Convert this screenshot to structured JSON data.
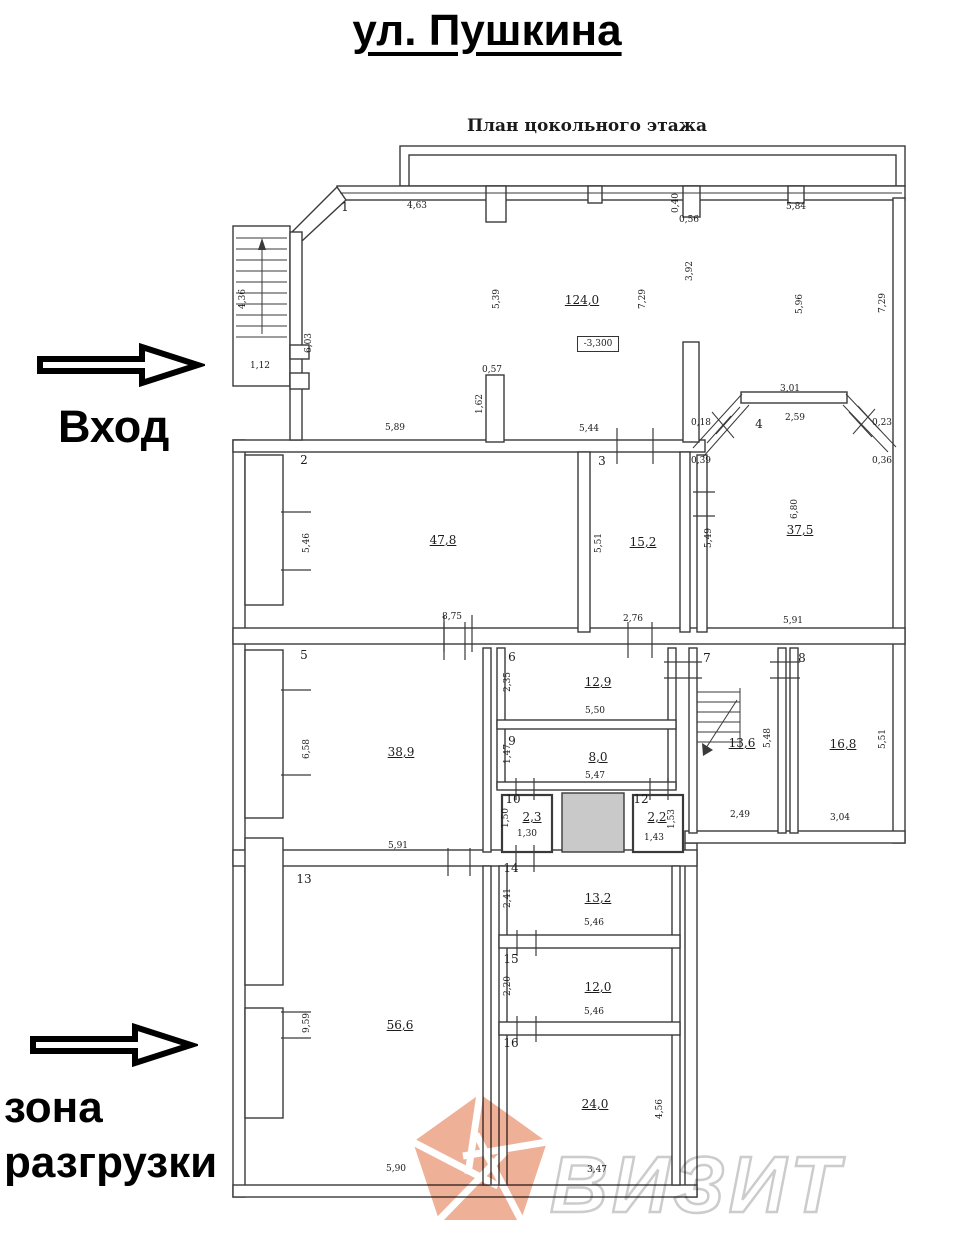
{
  "page": {
    "title": "ул. Пушкина",
    "subtitle": "План цокольного этажа"
  },
  "annotations": {
    "entrance": "Вход",
    "unloading_line1": "зона",
    "unloading_line2": "разгрузки",
    "elevation": "-3,300",
    "watermark": "ВИЗИТ"
  },
  "colors": {
    "wall": "#3a3a3a",
    "shaded_room": "#c9c9c9",
    "watermark_orange": "#eda58a",
    "watermark_text": "#cccccc"
  },
  "plan": {
    "rooms": [
      {
        "n": "1",
        "nx": 345,
        "ny": 207,
        "a": "124,0",
        "ax": 582,
        "ay": 300
      },
      {
        "n": "2",
        "nx": 304,
        "ny": 460,
        "a": "47,8",
        "ax": 443,
        "ay": 540
      },
      {
        "n": "3",
        "nx": 602,
        "ny": 461,
        "a": "15,2",
        "ax": 643,
        "ay": 542
      },
      {
        "n": "4",
        "nx": 759,
        "ny": 424,
        "a": "37,5",
        "ax": 800,
        "ay": 530
      },
      {
        "n": "5",
        "nx": 304,
        "ny": 655,
        "a": "38,9",
        "ax": 401,
        "ay": 752
      },
      {
        "n": "6",
        "nx": 512,
        "ny": 657,
        "a": "12,9",
        "ax": 598,
        "ay": 682
      },
      {
        "n": "7",
        "nx": 707,
        "ny": 658,
        "a": "13,6",
        "ax": 742,
        "ay": 743
      },
      {
        "n": "8",
        "nx": 802,
        "ny": 658,
        "a": "16,8",
        "ax": 843,
        "ay": 744
      },
      {
        "n": "9",
        "nx": 512,
        "ny": 741,
        "a": "8,0",
        "ax": 598,
        "ay": 757
      },
      {
        "n": "10",
        "nx": 513,
        "ny": 799,
        "a": "2,3",
        "ax": 532,
        "ay": 817
      },
      {
        "n": "12",
        "nx": 641,
        "ny": 799,
        "a": "2,2",
        "ax": 657,
        "ay": 817
      },
      {
        "n": "13",
        "nx": 304,
        "ny": 879,
        "a": "56,6",
        "ax": 400,
        "ay": 1025
      },
      {
        "n": "14",
        "nx": 511,
        "ny": 868,
        "a": "13,2",
        "ax": 598,
        "ay": 898
      },
      {
        "n": "15",
        "nx": 511,
        "ny": 959,
        "a": "12,0",
        "ax": 598,
        "ay": 987
      },
      {
        "n": "16",
        "nx": 511,
        "ny": 1043,
        "a": "24,0",
        "ax": 595,
        "ay": 1104
      }
    ],
    "dimensions": [
      {
        "t": "4,63",
        "x": 417,
        "y": 206
      },
      {
        "t": "0,40",
        "x": 676,
        "y": 203,
        "r": 1
      },
      {
        "t": "0,56",
        "x": 689,
        "y": 220
      },
      {
        "t": "5,84",
        "x": 796,
        "y": 207
      },
      {
        "t": "3,92",
        "x": 690,
        "y": 271,
        "r": 1
      },
      {
        "t": "5,39",
        "x": 497,
        "y": 299,
        "r": 1
      },
      {
        "t": "7,29",
        "x": 643,
        "y": 299,
        "r": 1
      },
      {
        "t": "5,96",
        "x": 800,
        "y": 304,
        "r": 1
      },
      {
        "t": "7,29",
        "x": 883,
        "y": 303,
        "r": 1
      },
      {
        "t": "4,36",
        "x": 243,
        "y": 299,
        "r": 1
      },
      {
        "t": "6,03",
        "x": 309,
        "y": 343,
        "r": 1
      },
      {
        "t": "1,12",
        "x": 260,
        "y": 366
      },
      {
        "t": "0,57",
        "x": 492,
        "y": 370
      },
      {
        "t": "1,62",
        "x": 480,
        "y": 404,
        "r": 1
      },
      {
        "t": "5,89",
        "x": 395,
        "y": 428
      },
      {
        "t": "5,44",
        "x": 589,
        "y": 429
      },
      {
        "t": "3,01",
        "x": 790,
        "y": 389
      },
      {
        "t": "2,59",
        "x": 795,
        "y": 418
      },
      {
        "t": "0,18",
        "x": 701,
        "y": 423
      },
      {
        "t": "0,23",
        "x": 882,
        "y": 423
      },
      {
        "t": "0,39",
        "x": 701,
        "y": 461
      },
      {
        "t": "0,36",
        "x": 882,
        "y": 461
      },
      {
        "t": "5,46",
        "x": 307,
        "y": 543,
        "r": 1
      },
      {
        "t": "5,51",
        "x": 599,
        "y": 543,
        "r": 1
      },
      {
        "t": "5,49",
        "x": 709,
        "y": 538,
        "r": 1
      },
      {
        "t": "6,80",
        "x": 795,
        "y": 509,
        "r": 1
      },
      {
        "t": "8,75",
        "x": 452,
        "y": 617
      },
      {
        "t": "2,76",
        "x": 633,
        "y": 619
      },
      {
        "t": "5,91",
        "x": 793,
        "y": 621
      },
      {
        "t": "6,58",
        "x": 307,
        "y": 749,
        "r": 1
      },
      {
        "t": "2,35",
        "x": 508,
        "y": 682,
        "r": 1
      },
      {
        "t": "5,50",
        "x": 595,
        "y": 711
      },
      {
        "t": "1,47",
        "x": 508,
        "y": 754,
        "r": 1
      },
      {
        "t": "5,47",
        "x": 595,
        "y": 776
      },
      {
        "t": "5,48",
        "x": 768,
        "y": 738,
        "r": 1
      },
      {
        "t": "5,51",
        "x": 883,
        "y": 739,
        "r": 1
      },
      {
        "t": "2,49",
        "x": 740,
        "y": 815
      },
      {
        "t": "3,04",
        "x": 840,
        "y": 818
      },
      {
        "t": "5,91",
        "x": 398,
        "y": 846
      },
      {
        "t": "1,50",
        "x": 506,
        "y": 818,
        "r": 1
      },
      {
        "t": "1,30",
        "x": 527,
        "y": 834
      },
      {
        "t": "1,53",
        "x": 672,
        "y": 819,
        "r": 1
      },
      {
        "t": "1,43",
        "x": 654,
        "y": 838
      },
      {
        "t": "9,59",
        "x": 307,
        "y": 1023,
        "r": 1
      },
      {
        "t": "2,41",
        "x": 508,
        "y": 898,
        "r": 1
      },
      {
        "t": "5,46",
        "x": 594,
        "y": 923
      },
      {
        "t": "2,20",
        "x": 508,
        "y": 986,
        "r": 1
      },
      {
        "t": "5,46",
        "x": 594,
        "y": 1012
      },
      {
        "t": "4,56",
        "x": 660,
        "y": 1109,
        "r": 1
      },
      {
        "t": "5,90",
        "x": 396,
        "y": 1169
      },
      {
        "t": "3,47",
        "x": 597,
        "y": 1170
      }
    ]
  }
}
